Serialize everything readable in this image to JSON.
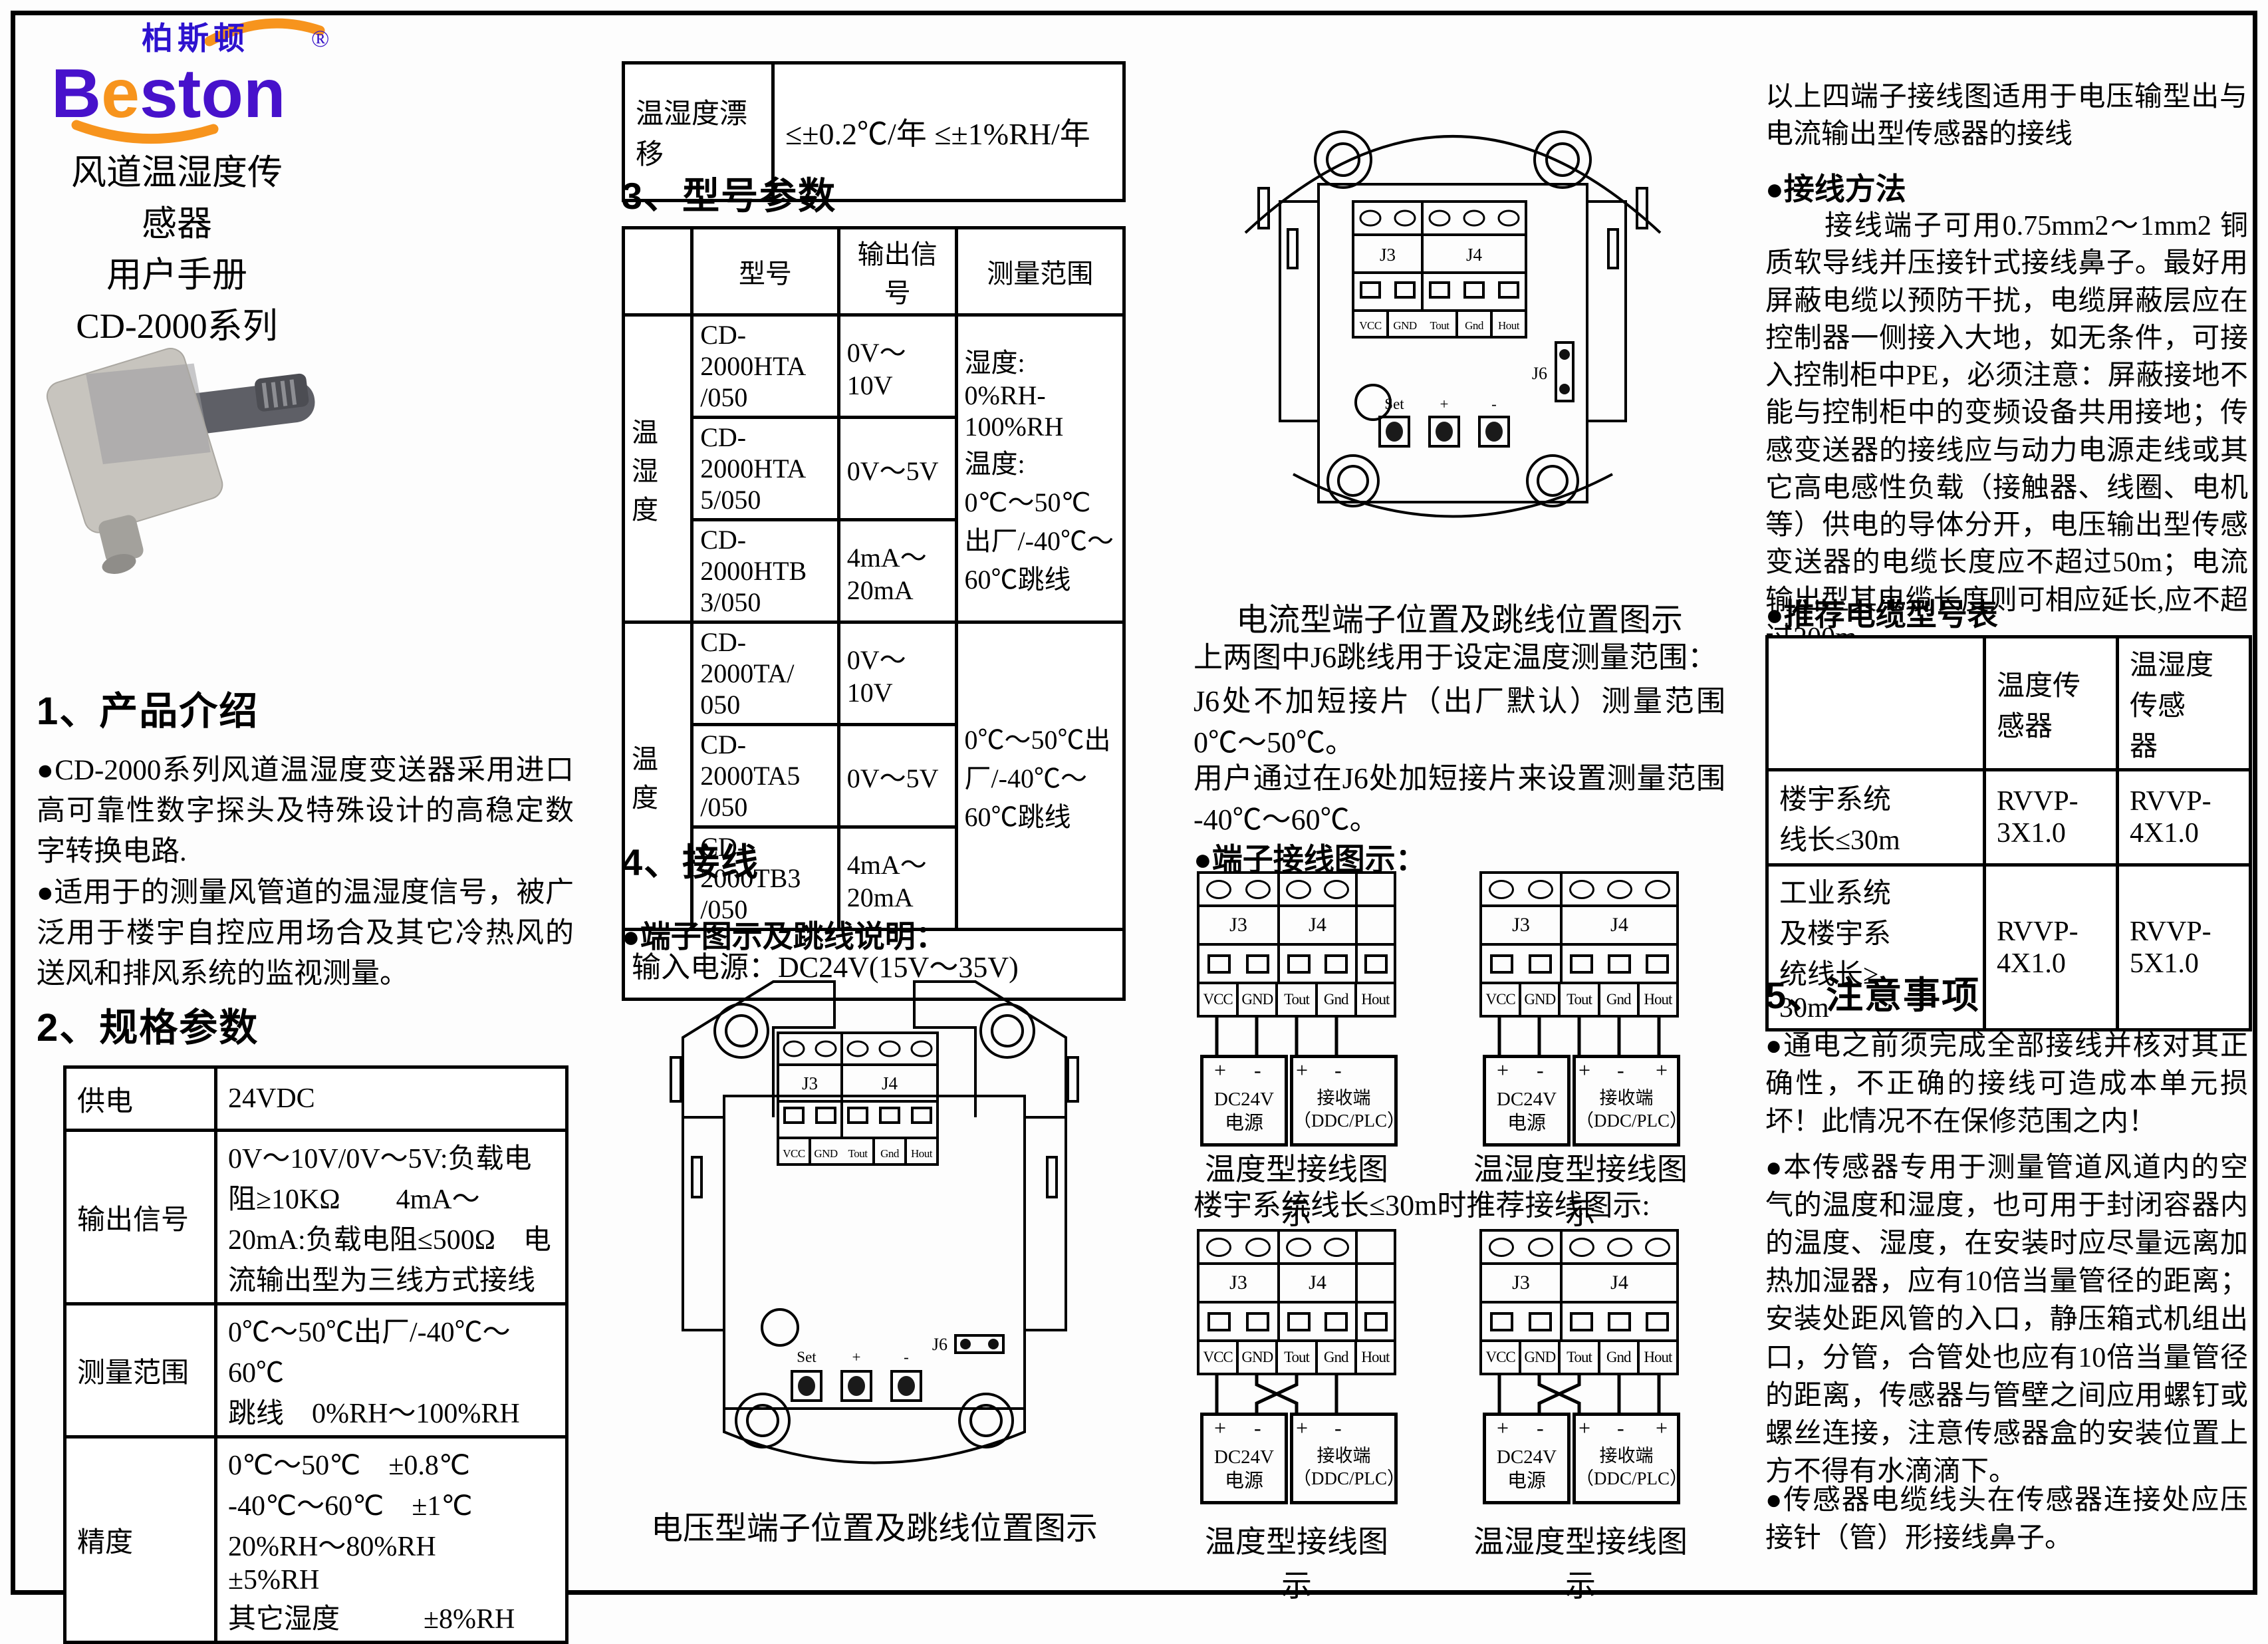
{
  "logo": {
    "cn": "柏斯顿",
    "en_b": "B",
    "en_e": "e",
    "en_rest": "ston",
    "reg": "®",
    "purple": "#3c10c9",
    "orange": "#f7941d"
  },
  "title_lines": {
    "l1": "风道温湿度传感器",
    "l2": "用户手册",
    "l3": "CD-2000系列"
  },
  "s1": {
    "heading": "1、产品介绍",
    "p1": "●CD-2000系列风道温湿度变送器采用进口高可靠性数字探头及特殊设计的高稳定数字转换电路.",
    "p2": "●适用于的测量风管道的温湿度信号，被广泛用于楼宇自控应用场合及其它冷热风的送风和排风系统的监视测量。"
  },
  "s2": {
    "heading": "2、规格参数",
    "rows": [
      [
        "供电",
        "24VDC"
      ],
      [
        "输出信号",
        "0V～10V/0V～5V:负载电阻≥10KΩ　　4mA～20mA:负载电阻≤500Ω　电流输出型为三线方式接线"
      ],
      [
        "测量范围",
        "0℃～50℃出厂/-40℃～60℃\n跳线　0%RH～100%RH"
      ],
      [
        "精度",
        "0℃～50℃　±0.8℃\n-40℃～60℃　±1℃\n20%RH～80%RH　±5%RH\n其它湿度　　　±8%RH"
      ]
    ]
  },
  "drift": {
    "label": "温湿度漂移",
    "value": "≤±0.2℃/年 ≤±1%RH/年"
  },
  "s3": {
    "heading": "3、型号参数",
    "col_model": "型号",
    "col_out": "输出信\n号",
    "col_range": "测量范围",
    "g1": {
      "name": "温湿度",
      "r1m": "CD-2000HTA\n/050",
      "r1o": "0V～10V",
      "r2m": "CD-2000HTA\n5/050",
      "r2o": "0V～5V",
      "r3m": "CD-2000HTB\n3/050",
      "r3o": "4mA～20mA",
      "range": "湿度:\n0%RH-100%RH\n温度:\n0℃～50℃\n出厂/-40℃～\n60℃跳线"
    },
    "g2": {
      "name": "温度",
      "r1m": "CD-2000TA/\n050",
      "r1o": "0V～10V",
      "r2m": "CD-2000TA5\n/050",
      "r2o": "0V～5V",
      "r3m": "CD-2000TB3\n/050",
      "r3o": "4mA～20mA",
      "range": "0℃～50℃出\n厂/-40℃～\n60℃跳线"
    },
    "footer": "输入电源：DC24V(15V～35V)"
  },
  "s4": {
    "heading": "4、接线",
    "sub": "●端子图示及跳线说明："
  },
  "wiring": {
    "j3": "J3",
    "j4": "J4",
    "pins": [
      "VCC",
      "GND",
      "Tout",
      "Gnd",
      "Hout"
    ],
    "j6": "J6",
    "set": "Set",
    "plus": "+",
    "minus": "-",
    "dc_box": "DC24V\n电源",
    "recv_box": "接收端\n（DDC/PLC）"
  },
  "captions": {
    "voltage": "电压型端子位置及跳线位置图示",
    "current": "电流型端子位置及跳线位置图示"
  },
  "col3": {
    "j6_p1": "上两图中J6跳线用于设定温度测量范围：",
    "j6_p2": "J6处不加短接片（出厂默认）测量范围 0℃～50℃。",
    "j6_p3": "用户通过在J6处加短接片来设置测量范围 -40℃～60℃。",
    "term_head": "●端子接线图示：",
    "rec_line": "楼宇系统线长≤30m时推荐接线图示:",
    "cap_temp": "温度型接线图示",
    "cap_th": "温湿度型接线图示"
  },
  "col4": {
    "p_top": "以上四端子接线图适用于电压输型出与电流输出型传感器的接线",
    "h_method": "●接线方法",
    "p_method": "　　接线端子可用0.75mm2～1mm2 铜质软导线并压接针式接线鼻子。最好用屏蔽电缆以预防干扰，电缆屏蔽层应在控制器一侧接入大地，如无条件，可接入控制柜中PE，必须注意：屏蔽接地不能与控制柜中的变频设备共用接地；传感变送器的接线应与动力电源走线或其它高电感性负载（接触器、线圈、电机等）供电的导体分开，电压输出型传感变送器的电缆长度应不超过50m；电流输出型其电缆长度则可相应延长,应不超过200m。",
    "h_cable": "●推荐电缆型号表"
  },
  "cable": {
    "h_temp": "温度传感器",
    "h_th": "温湿度传感\n器",
    "r1label": "楼宇系统\n线长≤30m",
    "r1temp": "RVVP-3X1.0",
    "r1th": "RVVP-4X1.0",
    "r2label": "工业系统\n及楼宇系\n统线长≥\n30m",
    "r2temp": "RVVP-4X1.0",
    "r2th": "RVVP-5X1.0"
  },
  "s5": {
    "heading": "5、注意事项",
    "n1": "●通电之前须完成全部接线并核对其正确性，不正确的接线可造成本单元损坏！此情况不在保修范围之内！",
    "n2": "●本传感器专用于测量管道风道内的空气的温度和湿度，也可用于封闭容器内的温度、湿度，在安装时应尽量远离加热加湿器，应有10倍当量管径的距离；安装处距风管的入口，静压箱式机组出口，分管，合管处也应有10倍当量管径的距离，传感器与管壁之间应用螺钉或螺丝连接，注意传感器盒的安装位置上方不得有水滴滴下。",
    "n3": "●传感器电缆线头在传感器连接处应压接针（管）形接线鼻子。"
  }
}
